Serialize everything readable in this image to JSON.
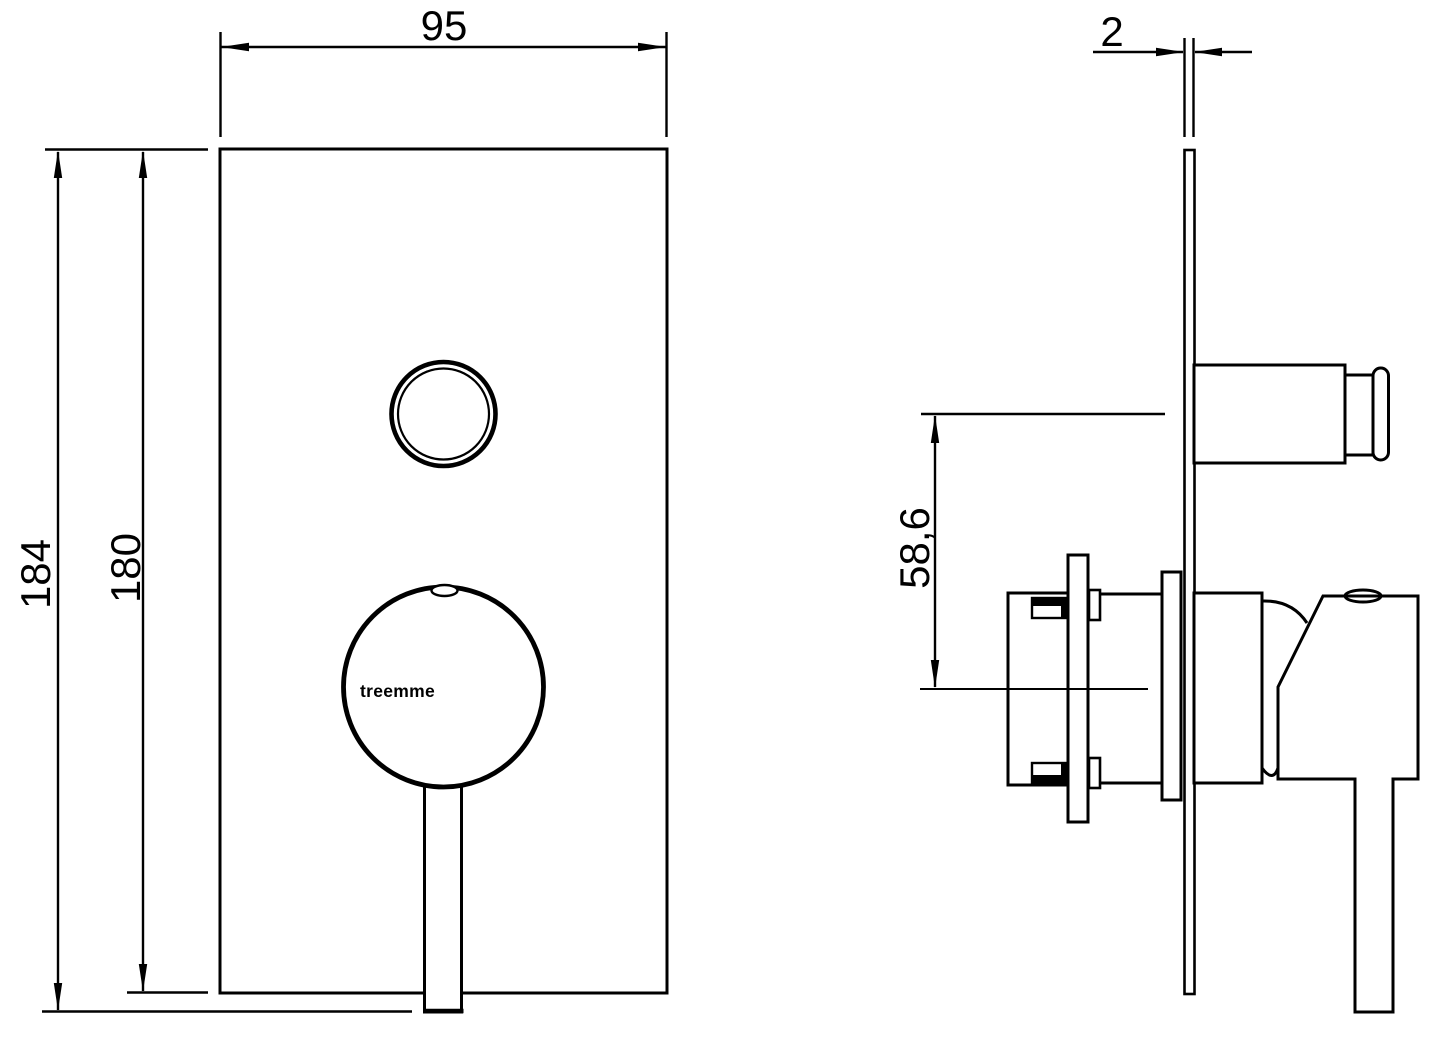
{
  "drawing": {
    "brand_logo": "treemme",
    "views": {
      "front": {
        "width_mm": "95",
        "height_overall_mm": "184",
        "height_plate_mm": "180"
      },
      "side": {
        "plate_thickness_mm": "2",
        "button_to_handle_spacing_mm": "58,6"
      }
    }
  },
  "colors": {
    "line": "#000000",
    "background": "#ffffff"
  }
}
